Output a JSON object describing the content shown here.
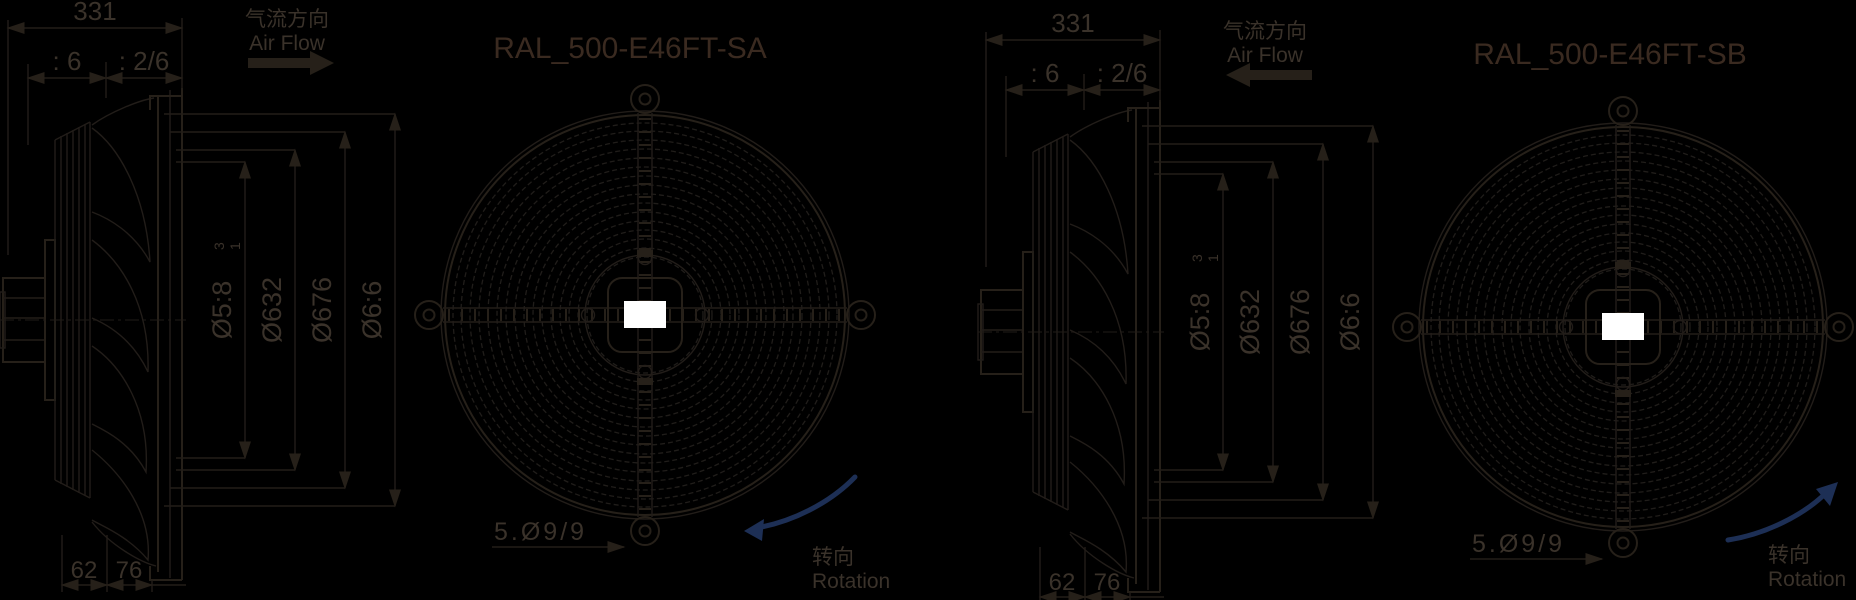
{
  "background_color": "#000000",
  "line_color": "#262019",
  "text_color": "#3a322a",
  "title_color": "#3a2a20",
  "rotation_arrow_color": "#1d2f55",
  "nameplate_color": "#ffffff",
  "labels": {
    "airflow_zh": "气流方向",
    "airflow_en": "Air Flow",
    "rotation_zh": "转向",
    "rotation_en": "Rotation"
  },
  "dims": {
    "total_depth": "331",
    "seg_a": ": 6",
    "seg_b": ": 2/6",
    "dia_1": "Ø5:8",
    "dia_1_tol_top": "3",
    "dia_1_tol_bottom": "1",
    "dia_2": "Ø632",
    "dia_3": "Ø676",
    "dia_4": "Ø6:6",
    "bottom_a": "62",
    "bottom_b": "76",
    "holes": "5.Ø9/9"
  },
  "drawings": [
    {
      "title": "RAL_500-E46FT-SA",
      "airflow_direction": "right",
      "rotation_direction": "counterclockwise"
    },
    {
      "title": "RAL_500-E46FT-SB",
      "airflow_direction": "left",
      "rotation_direction": "clockwise"
    }
  ]
}
